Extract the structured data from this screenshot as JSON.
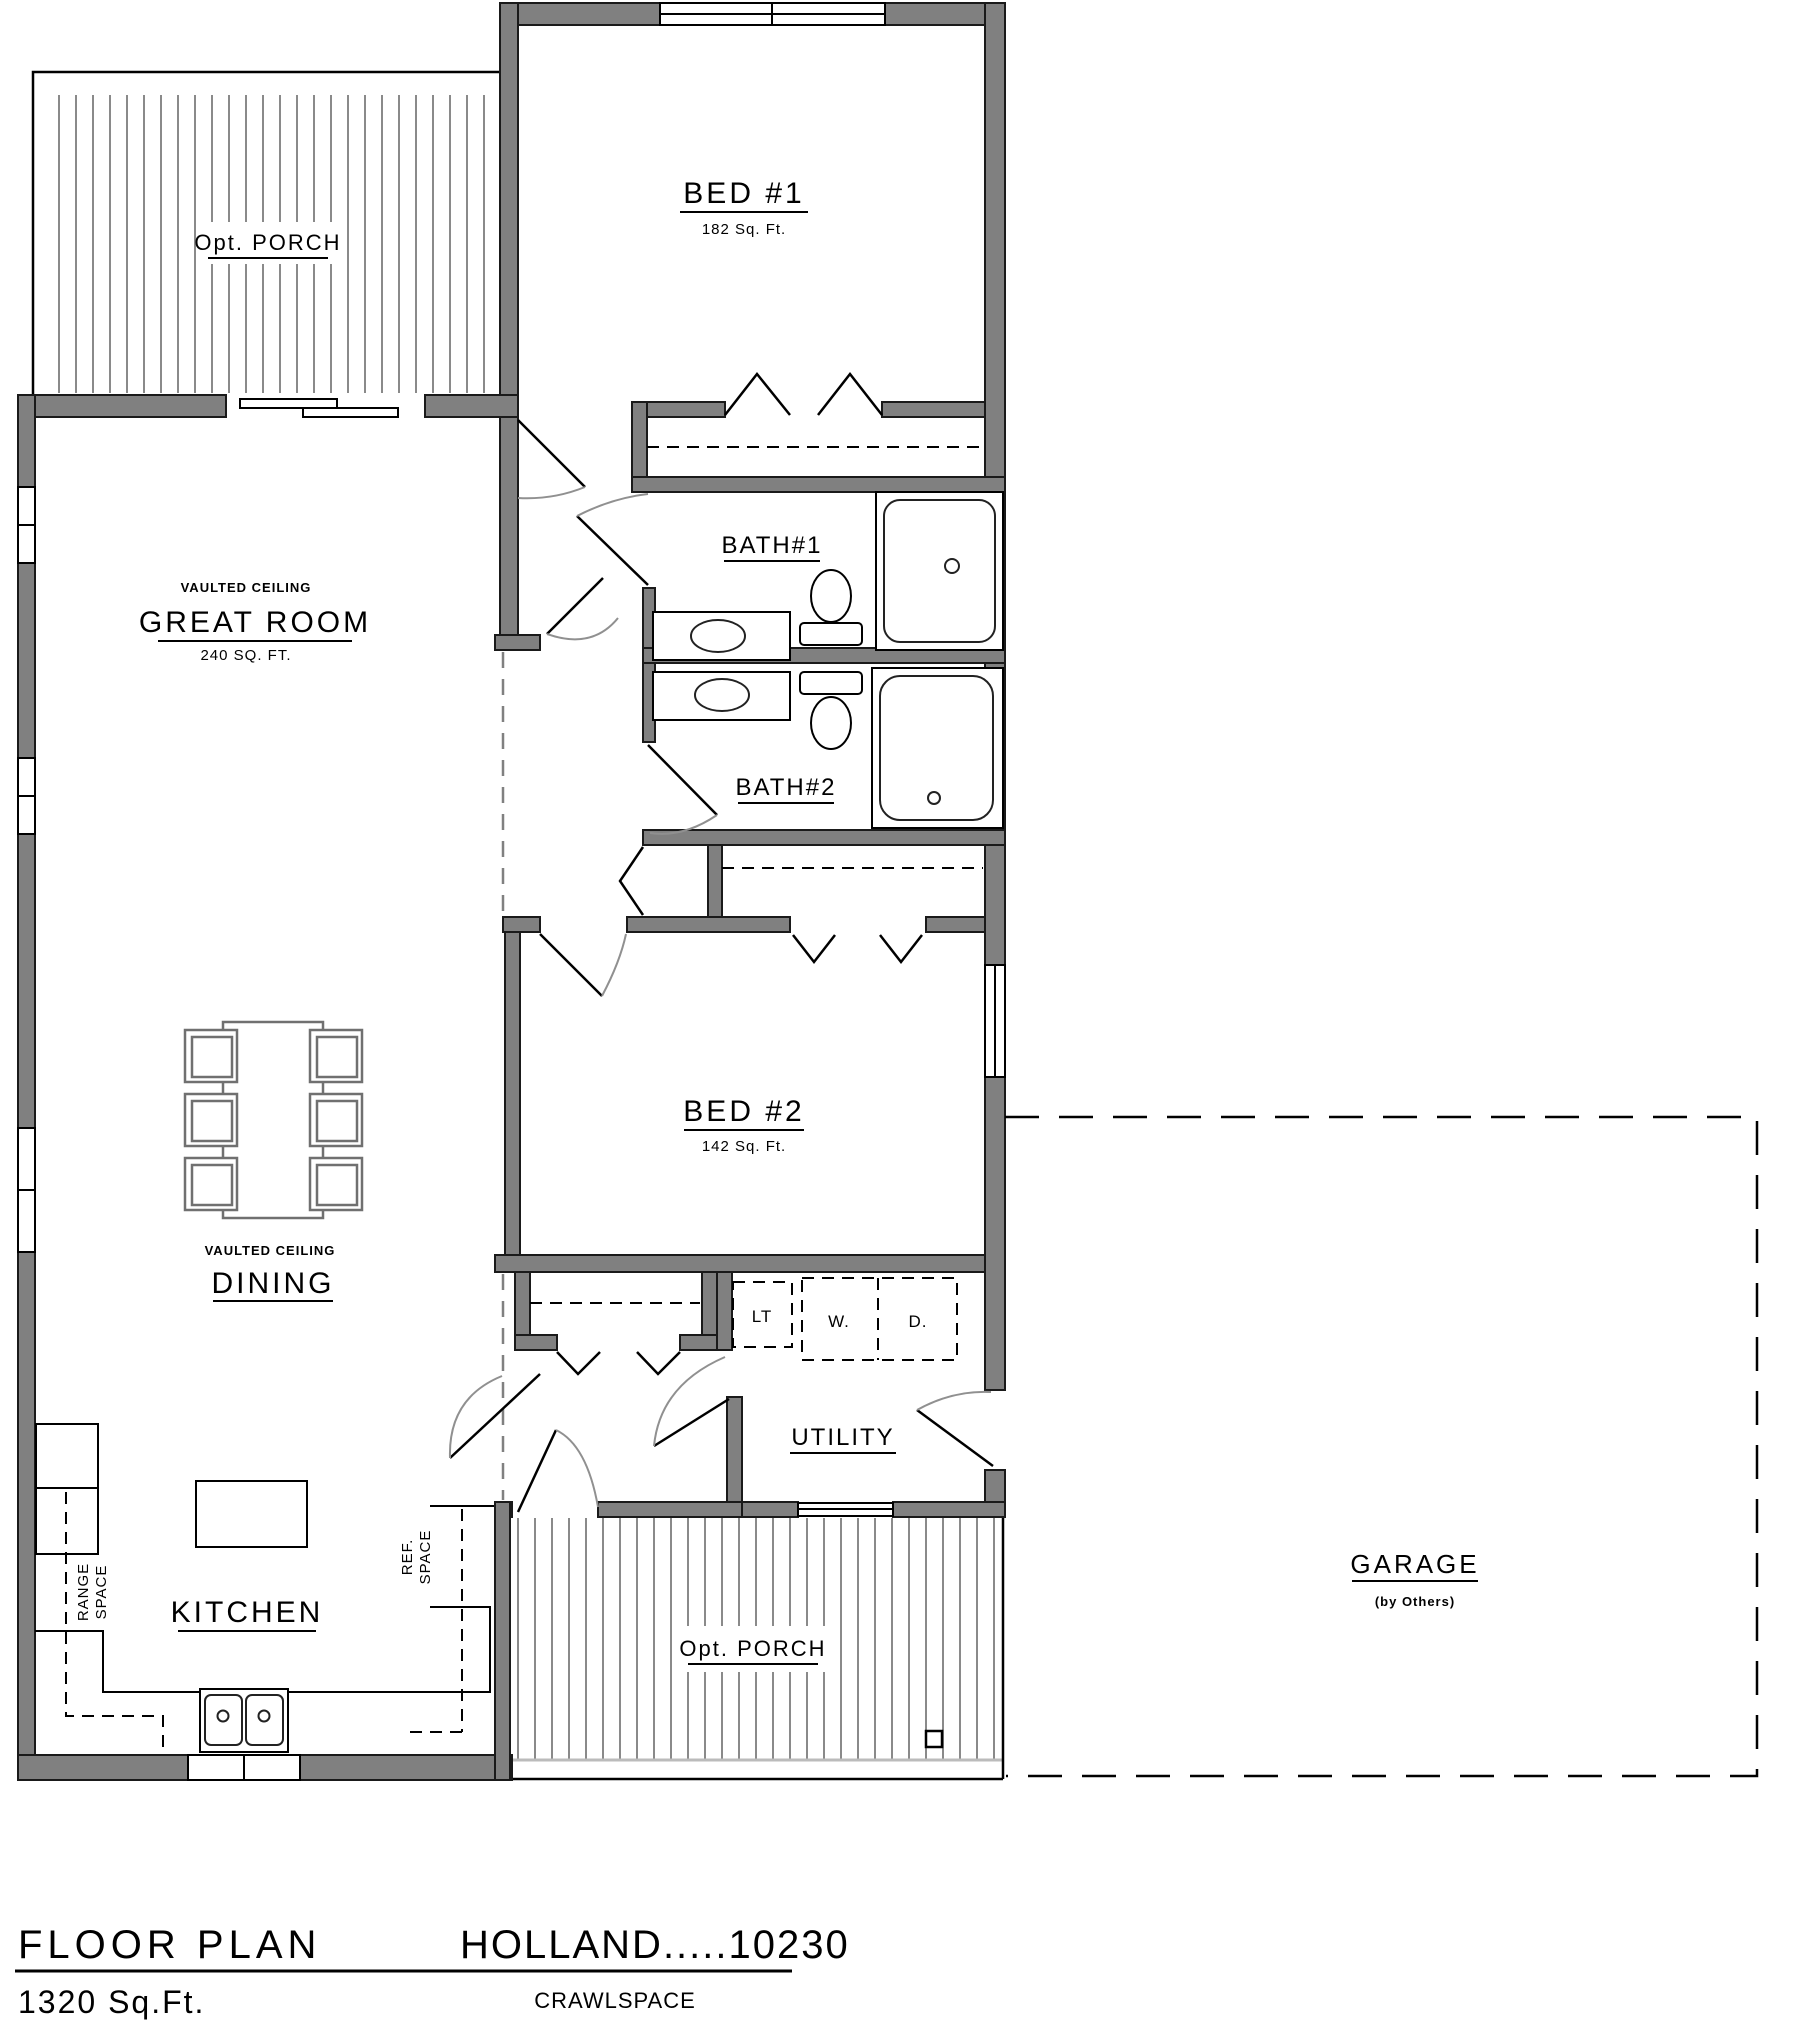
{
  "plan": {
    "rooms": {
      "porch_top": "Opt. PORCH",
      "bed1": "BED #1",
      "bed1_area": "182 Sq. Ft.",
      "bath1": "BATH#1",
      "bath2": "BATH#2",
      "great_room_note": "VAULTED CEILING",
      "great_room": "GREAT ROOM",
      "great_room_area": "240 SQ. FT.",
      "dining_note": "VAULTED CEILING",
      "dining": "DINING",
      "bed2": "BED #2",
      "bed2_area": "142 Sq. Ft.",
      "utility": "UTILITY",
      "laundry_tub": "LT",
      "washer": "W.",
      "dryer": "D.",
      "kitchen": "KITCHEN",
      "range_line1": "RANGE",
      "range_line2": "SPACE",
      "ref_line1": "REF.",
      "ref_line2": "SPACE",
      "porch_bottom": "Opt. PORCH",
      "garage": "GARAGE",
      "garage_note": "(by Others)"
    },
    "title_block": {
      "title": "FLOOR PLAN",
      "model": "HOLLAND.....10230",
      "area": "1320  Sq.Ft.",
      "foundation": "CRAWLSPACE"
    },
    "colors": {
      "wall": "#808080",
      "line": "#000000",
      "hatch": "#8a8a8a",
      "door_arc": "#909090",
      "furniture": "#707070"
    }
  }
}
